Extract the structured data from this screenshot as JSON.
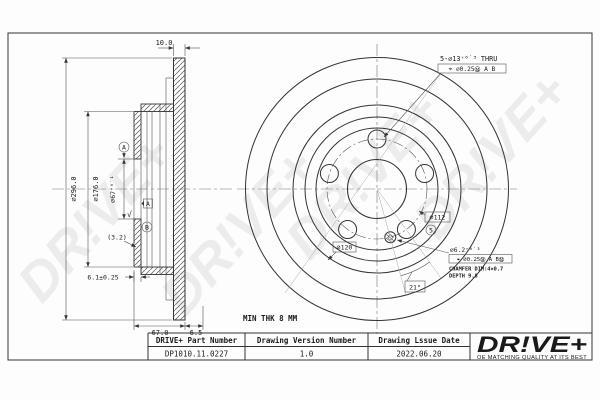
{
  "drawing": {
    "watermark": "DR!VE+",
    "left_view": {
      "dim_disc_thickness": "10.0",
      "dim_outer_diameter": "∅296.0",
      "dim_hat_diameter": "∅176.0",
      "dim_center_bore": "∅67⁺⁰˙¹",
      "dim_plate_thickness": "6.1±0.25",
      "dim_wall_ref": "(3.2)",
      "dim_total_height": "67.0",
      "dim_face_offset": "6.5",
      "datum_a": "A",
      "datum_b": "B",
      "roughness_mark": "√"
    },
    "front_view": {
      "min_thickness_note": "MIN THK 8 MM",
      "lug_hole_callout": "5-∅13⁺⁰˙³ THRU",
      "lug_hole_gdt": "⌖ ∅0.25Ⓜ A B",
      "pcd_label": "∅112",
      "hole_count_badge": "5",
      "inner_circle_label": "∅120",
      "angle_label": "21°",
      "pin_hole_diameter": "∅6.2⁺⁰˙³",
      "pin_hole_gdt": "⌖ ∅0.25Ⓜ A BⓂ",
      "pin_hole_note1": "CHAMFER DIM:4×0.7",
      "pin_hole_note2": "DEPTH 9.8"
    }
  },
  "title_block": {
    "part_number_header": "DRIVE+ Part Number",
    "part_number_value": "DP1010.11.0227",
    "version_header": "Drawing Version Number",
    "version_value": "1.0",
    "issue_date_header": "Drawing Lssue Date",
    "issue_date_value": "2022.06.20",
    "brand_logo": "DR!VE+",
    "brand_tagline": "OE MATCHING QUALITY AT ITS BEST",
    "brand_color": "#E8491D"
  }
}
